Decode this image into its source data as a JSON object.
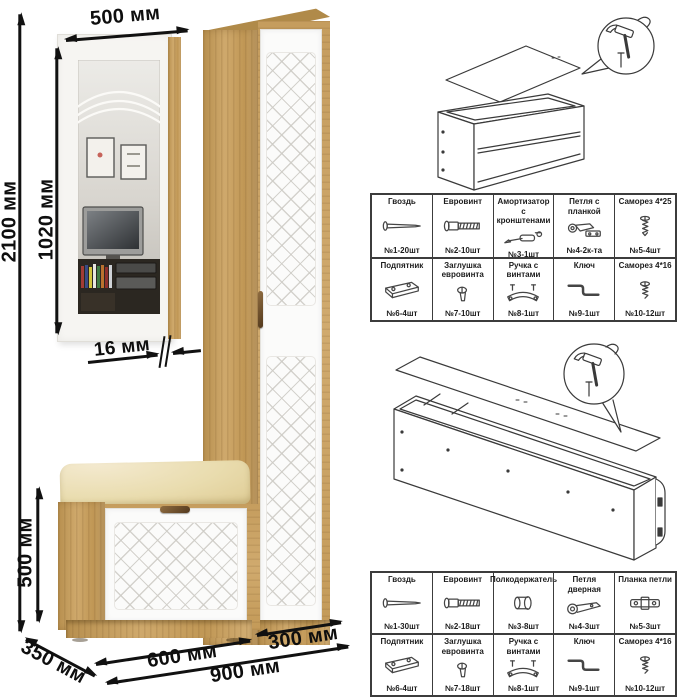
{
  "dimensions": {
    "mirror_width": "500 мм",
    "total_height": "2100 мм",
    "mirror_height": "1020 мм",
    "panel_thickness": "16 мм",
    "bench_height": "500 мм",
    "depth": "350 мм",
    "bench_width": "600 мм",
    "cabinet_width": "300 мм",
    "total_width": "900 мм"
  },
  "colors": {
    "wood": "#c9a265",
    "wood-dark": "#b08a49",
    "door-white": "#fbfbfa",
    "cushion": "#ecdfb4",
    "ink": "#111111",
    "sketch-ink": "#3a3a3a"
  },
  "assembly_diagrams": [
    {
      "name": "bench-back-panel-nailing",
      "tool_icon": "hammer-icon",
      "fastener_icon": "nail-icon"
    },
    {
      "name": "cabinet-back-panel-nailing",
      "tool_icon": "hammer-icon",
      "fastener_icon": "nail-icon"
    }
  ],
  "hardware_tables": [
    {
      "name": "bench-hardware-table",
      "rows": [
        [
          {
            "label": "Гвоздь",
            "icon": "nail-icon",
            "qty": "№1-20шт"
          },
          {
            "label": "Евровинт",
            "icon": "euroscrew-icon",
            "qty": "№2-10шт"
          },
          {
            "label": "Амортизатор с кронштенами",
            "icon": "gas-lift-icon",
            "qty": "№3-1шт"
          },
          {
            "label": "Петля с планкой",
            "icon": "hinge-with-plate-icon",
            "qty": "№4-2к-та"
          },
          {
            "label": "Саморез 4*25",
            "icon": "screw-4x25-icon",
            "qty": "№5-4шт"
          }
        ],
        [
          {
            "label": "Подпятник",
            "icon": "foot-pad-icon",
            "qty": "№6-4шт"
          },
          {
            "label": "Заглушка евровинта",
            "icon": "euroscrew-cap-icon",
            "qty": "№7-10шт"
          },
          {
            "label": "Ручка с винтами",
            "icon": "handle-icon",
            "qty": "№8-1шт"
          },
          {
            "label": "Ключ",
            "icon": "hex-key-icon",
            "qty": "№9-1шт"
          },
          {
            "label": "Саморез 4*16",
            "icon": "screw-4x16-icon",
            "qty": "№10-12шт"
          }
        ]
      ]
    },
    {
      "name": "cabinet-hardware-table",
      "rows": [
        [
          {
            "label": "Гвоздь",
            "icon": "nail-icon",
            "qty": "№1-30шт"
          },
          {
            "label": "Евровинт",
            "icon": "euroscrew-icon",
            "qty": "№2-18шт"
          },
          {
            "label": "Полкодержатель",
            "icon": "shelf-pin-icon",
            "qty": "№3-8шт"
          },
          {
            "label": "Петля дверная",
            "icon": "door-hinge-icon",
            "qty": "№4-3шт"
          },
          {
            "label": "Планка петли",
            "icon": "hinge-plate-icon",
            "qty": "№5-3шт"
          }
        ],
        [
          {
            "label": "Подпятник",
            "icon": "foot-pad-icon",
            "qty": "№6-4шт"
          },
          {
            "label": "Заглушка евровинта",
            "icon": "euroscrew-cap-icon",
            "qty": "№7-18шт"
          },
          {
            "label": "Ручка с винтами",
            "icon": "handle-icon",
            "qty": "№8-1шт"
          },
          {
            "label": "Ключ",
            "icon": "hex-key-icon",
            "qty": "№9-1шт"
          },
          {
            "label": "Саморез 4*16",
            "icon": "screw-4x16-icon",
            "qty": "№10-12шт"
          }
        ]
      ]
    }
  ]
}
